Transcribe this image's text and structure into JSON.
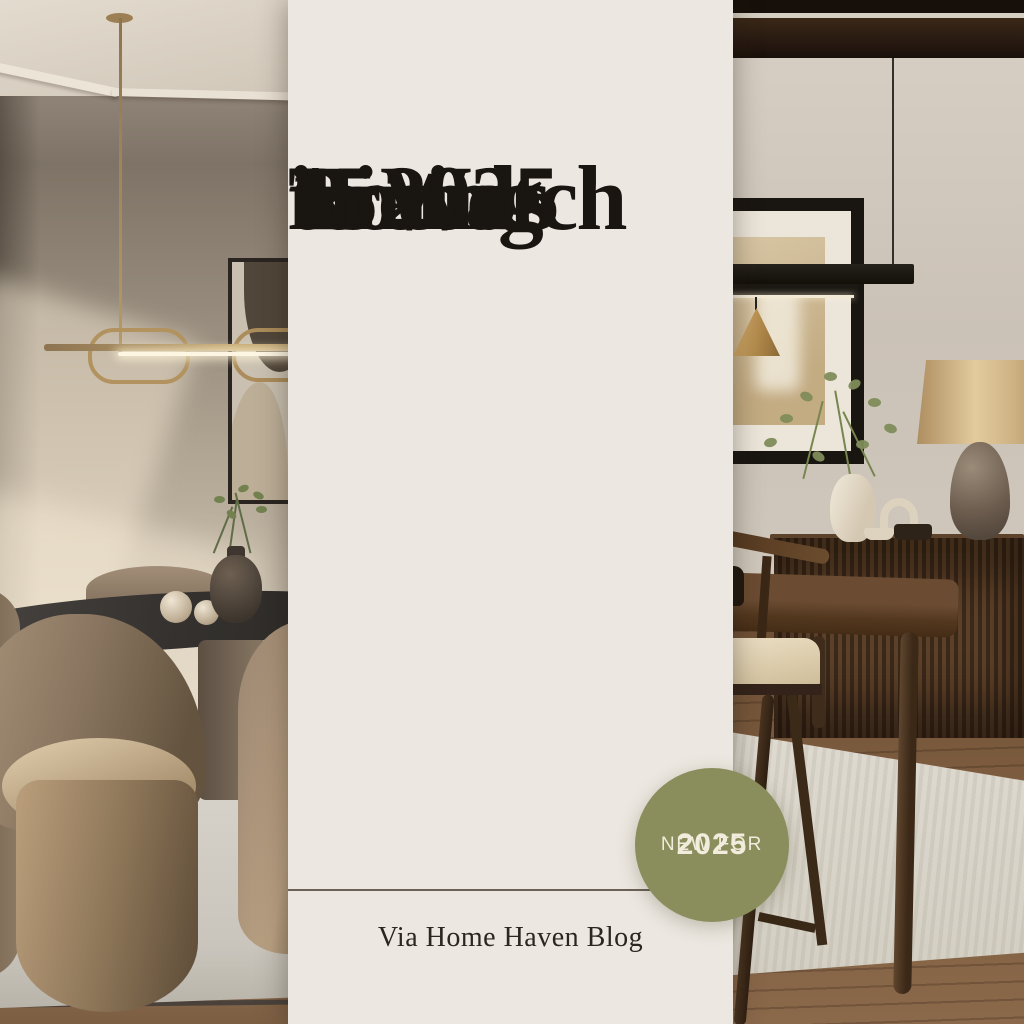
{
  "poster": {
    "title": {
      "lines": [
        "15",
        "Dining",
        "Room",
        "Trends",
        "to Watch",
        "in 2025"
      ]
    },
    "badge": {
      "line1": "NEW FOR",
      "line2": "2025"
    },
    "attribution": "Via Home Haven Blog",
    "colors": {
      "panel_bg": "#ece7e0",
      "title_text": "#191511",
      "badge_bg": "#8a8d5c",
      "badge_text": "#f1ecdb",
      "attribution_text": "#2b2620",
      "divider": "#4b4034"
    }
  },
  "scene": {
    "left_photo": {
      "wall": "#9c9182",
      "ceiling": "#ddd5c8",
      "sunlight": "#f3e7d1",
      "pendant_brass": "#b2925f",
      "art_frame": "#2a2521",
      "art_canvas": "#c9c0b1",
      "table": "#3a3734",
      "chair": "#8f7d69",
      "rug": "#d6d2c9",
      "floor": "#8a6c4e",
      "vase": "#4e443b",
      "spheres": "#e3d9c8",
      "plant": "#6f7d50"
    },
    "right_photo": {
      "wall": "#cfc7bc",
      "beam": "#2c1d12",
      "pendant_black": "#17140f",
      "cone_brass": "#c29b5d",
      "frame": "#191511",
      "frame_mat": "#ece6da",
      "artwork": "#d2bf9c",
      "lamp_shade": "#d9c295",
      "lamp_base": "#5f5348",
      "vase": "#e9e1d2",
      "branches": "#7d8a58",
      "sideboard": "#4f3725",
      "table": "#53381f",
      "chair_seat": "#e0d4ba",
      "chair_wood": "#3a281a",
      "rug": "#dcd7cd",
      "floor": "#755639"
    }
  }
}
